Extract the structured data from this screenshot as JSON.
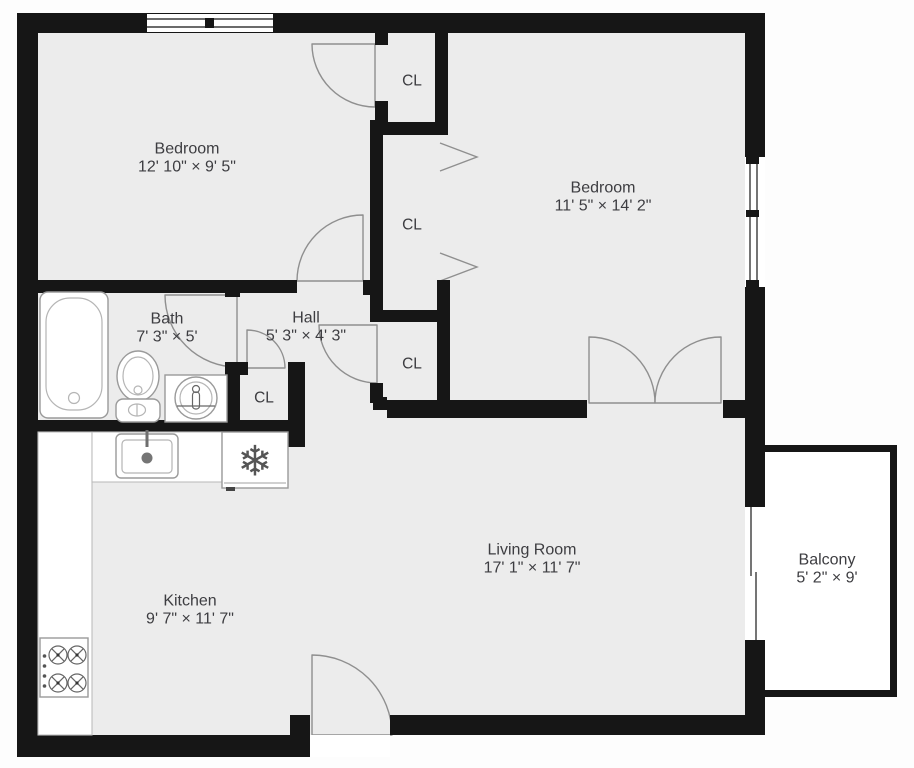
{
  "plan": {
    "closet_label": "CL",
    "rooms": [
      {
        "name": "Bedroom",
        "dims": "12' 10\" × 9' 5\""
      },
      {
        "name": "Bedroom",
        "dims": "11' 5\" × 14' 2\""
      },
      {
        "name": "Bath",
        "dims": "7' 3\" × 5'"
      },
      {
        "name": "Hall",
        "dims": "5' 3\" × 4' 3\""
      },
      {
        "name": "Kitchen",
        "dims": "9' 7\" × 11' 7\""
      },
      {
        "name": "Living Room",
        "dims": "17' 1\" × 11' 7\""
      },
      {
        "name": "Balcony",
        "dims": "5' 2\" × 9'"
      }
    ],
    "icons": {
      "snowflake": "❄"
    },
    "colors": {
      "wall": "#161616",
      "floor": "#ececec",
      "door_arc": "#8f8f8f",
      "fixture_outline": "#9a9a9a",
      "label_text": "#3d3d41",
      "background": "#fdfdfd"
    }
  }
}
